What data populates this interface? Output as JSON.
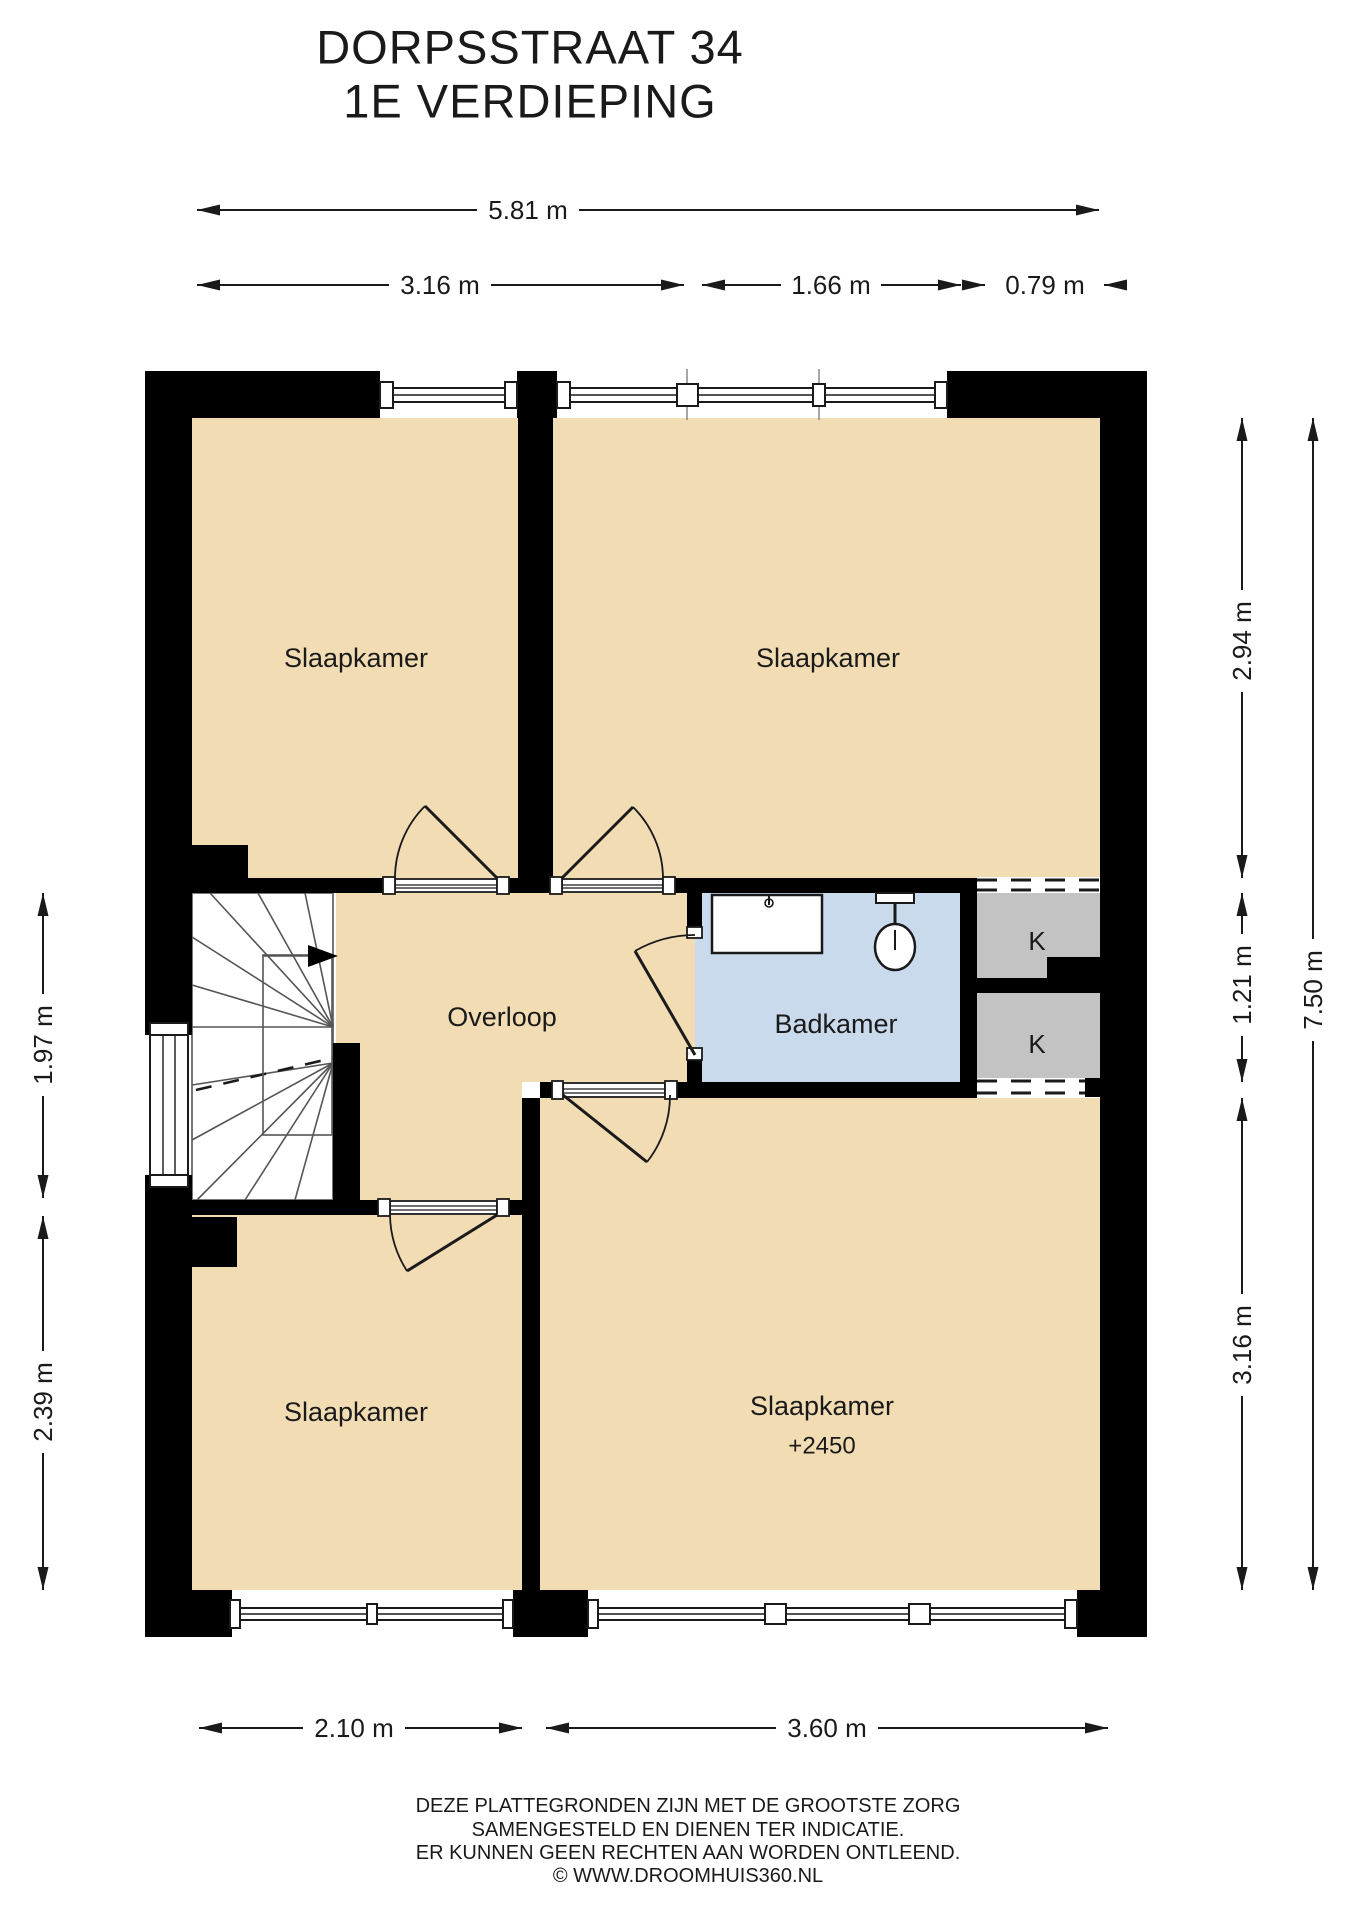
{
  "title": {
    "line1": "DORPSSTRAAT 34",
    "line2": "1E VERDIEPING"
  },
  "rooms": {
    "bedroom_top_left": "Slaapkamer",
    "bedroom_top_right": "Slaapkamer",
    "bedroom_bottom_left": "Slaapkamer",
    "bedroom_bottom_right": "Slaapkamer",
    "bedroom_bottom_right_level": "+2450",
    "landing": "Overloop",
    "bathroom": "Badkamer",
    "closet_top": "K",
    "closet_bottom": "K"
  },
  "dimensions": {
    "top_total": "5.81 m",
    "top_left": "3.16 m",
    "top_middle": "1.66 m",
    "top_right": "0.79 m",
    "right_top": "2.94 m",
    "right_middle": "1.21 m",
    "right_bottom": "3.16 m",
    "right_total": "7.50 m",
    "left_top": "1.97 m",
    "left_bottom": "2.39 m",
    "bottom_left": "2.10 m",
    "bottom_right": "3.60 m"
  },
  "footer": {
    "line1": "DEZE PLATTEGRONDEN ZIJN MET DE GROOTSTE ZORG",
    "line2": "SAMENGESTELD EN DIENEN TER INDICATIE.",
    "line3": "ER KUNNEN GEEN RECHTEN AAN WORDEN ONTLEEND.",
    "line4": "© WWW.DROOMHUIS360.NL"
  },
  "colors": {
    "floor": "#f2dcb4",
    "bathroom": "#c9daed",
    "closet": "#c3c3c3",
    "stairs": "#ffffff",
    "wall": "#000000",
    "line": "#1a1a1a"
  }
}
